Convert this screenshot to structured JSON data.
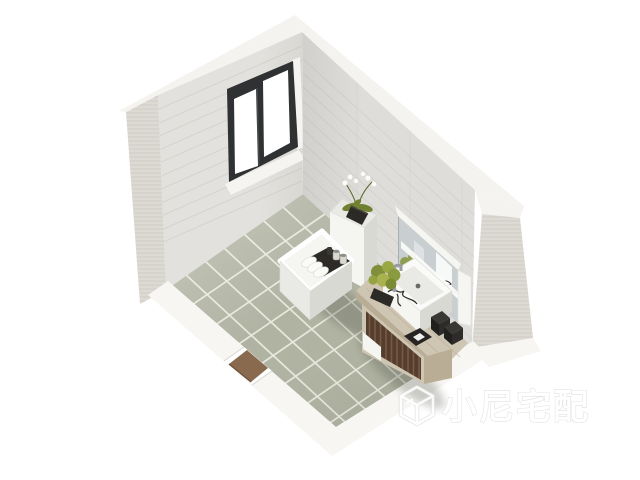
{
  "scene": {
    "description": "3D isometric interior render of a small bathroom",
    "objects": {
      "floor": "green-grey tiled floor",
      "left_wall": "tiled wall with sliding window",
      "right_wall": "tiled wall",
      "pony_walls": "cutaway low walls with door opening",
      "door_threshold": "wood door threshold",
      "window": "dark-framed sliding window",
      "toilet": "white toilet",
      "toilet_tray": "black tray with rolled towels and jars",
      "tank_plant": "white orchid in black pot",
      "vanity": "wood vanity cabinet with vessel sink",
      "sink": "white vessel sink with floral decal",
      "faucet": "chrome faucet",
      "mirror": "wall mirror cabinet with light bar",
      "counter_plants": "green flower pots",
      "accessories": "black bathroom accessories",
      "watermark": "brand watermark"
    }
  },
  "watermark": {
    "text": "小尼宅配",
    "logo": "cube-logo"
  },
  "palette": {
    "bg": "#ffffff",
    "wall_face": "#e2e1dd",
    "wall_face_right": "#deddda",
    "wall_top": "#f4f3ef",
    "wall_edge": "#dcdad3",
    "wall_course": "#d0cfc9",
    "floor_tile": "#b0b3a2",
    "floor_grout": "#ebebe1",
    "low_wall": "#f7f6f3",
    "low_wall_side": "#e7e5e1",
    "door_threshold": "#8a6a4e",
    "window_frame": "#2f3133",
    "window_pane": "#ffffff",
    "window_sill": "#f5f4f0",
    "fixture_white": "#f5f5f2",
    "fixture_shade": "#e9e9e5",
    "fixture_dark": "#d9d9d4",
    "tray_black": "#2d2a27",
    "counter_wood": "#cec5b2",
    "counter_wood_dark": "#b9ad96",
    "cabinet_slats": "#543e2f",
    "mirror_glass": "#c9ced1",
    "plant_green": "#7f8f3a",
    "pot_black": "#2c2a26",
    "chrome": "#979da1",
    "watermark_white": "#ffffff",
    "watermark_outline": "#d6d6d4"
  }
}
